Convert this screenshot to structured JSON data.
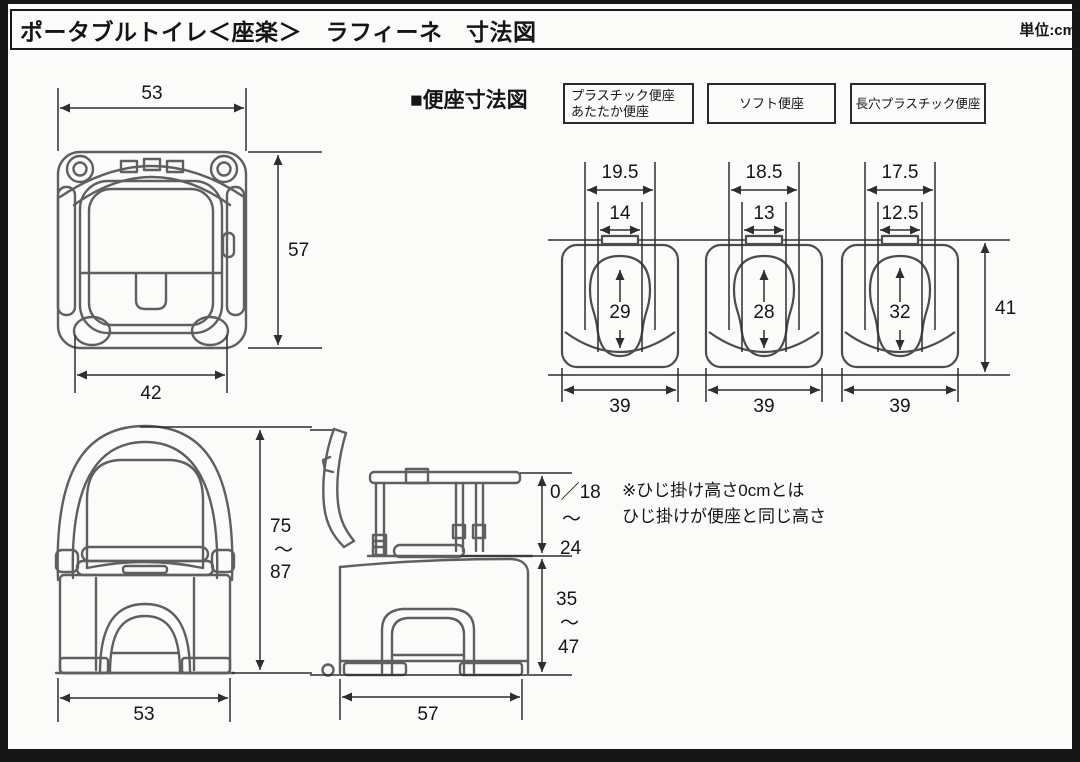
{
  "header": {
    "title": "ポータブルトイレ＜座楽＞　ラフィーネ　寸法図",
    "unit_label": "単位:cm"
  },
  "seat_section": {
    "heading": "■便座寸法図",
    "overall_depth": "41",
    "types": [
      {
        "label_line1": "プラスチック便座",
        "label_line2": "あたたか便座",
        "outer_width": "19.5",
        "inner_width": "14",
        "hole_length": "29",
        "base_width": "39"
      },
      {
        "label": "ソフト便座",
        "outer_width": "18.5",
        "inner_width": "13",
        "hole_length": "28",
        "base_width": "39"
      },
      {
        "label": "長穴プラスチック便座",
        "outer_width": "17.5",
        "inner_width": "12.5",
        "hole_length": "32",
        "base_width": "39"
      }
    ]
  },
  "top_view": {
    "width": "53",
    "depth": "57",
    "seat_width": "42"
  },
  "front_view": {
    "height_min": "75",
    "range_tilde": "～",
    "height_max": "87",
    "width": "53"
  },
  "side_view": {
    "armrest_height_min": "0／18",
    "range_tilde": "～",
    "armrest_height_max": "24",
    "seat_height_min": "35",
    "seat_height_tilde": "～",
    "seat_height_max": "47",
    "depth": "57"
  },
  "note": {
    "line1": "※ひじ掛け高さ0cmとは",
    "line2": "ひじ掛けが便座と同じ高さ"
  }
}
